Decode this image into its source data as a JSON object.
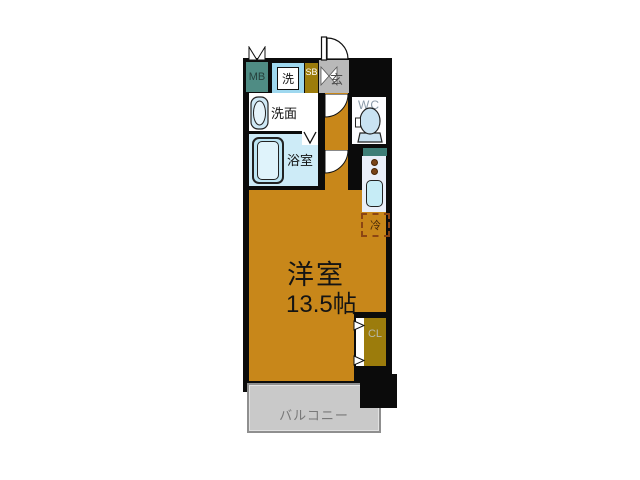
{
  "floor_plan": {
    "main_room_label": "洋室",
    "main_room_size": "13.5帖",
    "balcony_label": "バルコニー",
    "bathroom_label": "浴室",
    "washroom_label": "洗面",
    "washer_label": "洗",
    "meter_box_label": "MB",
    "shoe_box_label": "SB",
    "entrance_label": "玄",
    "wc_label": "WC",
    "closet_label": "CL",
    "fridge_label": "冷",
    "colors": {
      "wall": "#0b0b0b",
      "room_fill": "#c8871a",
      "bath_fill": "#cdebf7",
      "fixture_fill": "#bce5f4",
      "closet_fill": "#9c7c0c",
      "meter_box_fill": "#4f8c84",
      "counter_fill": "#3e7e77",
      "entrance_fill": "#b9b9b9",
      "balcony_fill": "#c9c9c9",
      "kitchen_fill": "#e9eff9",
      "fridge_outline": "#8b4513",
      "burner_color": "#7a4418"
    }
  }
}
